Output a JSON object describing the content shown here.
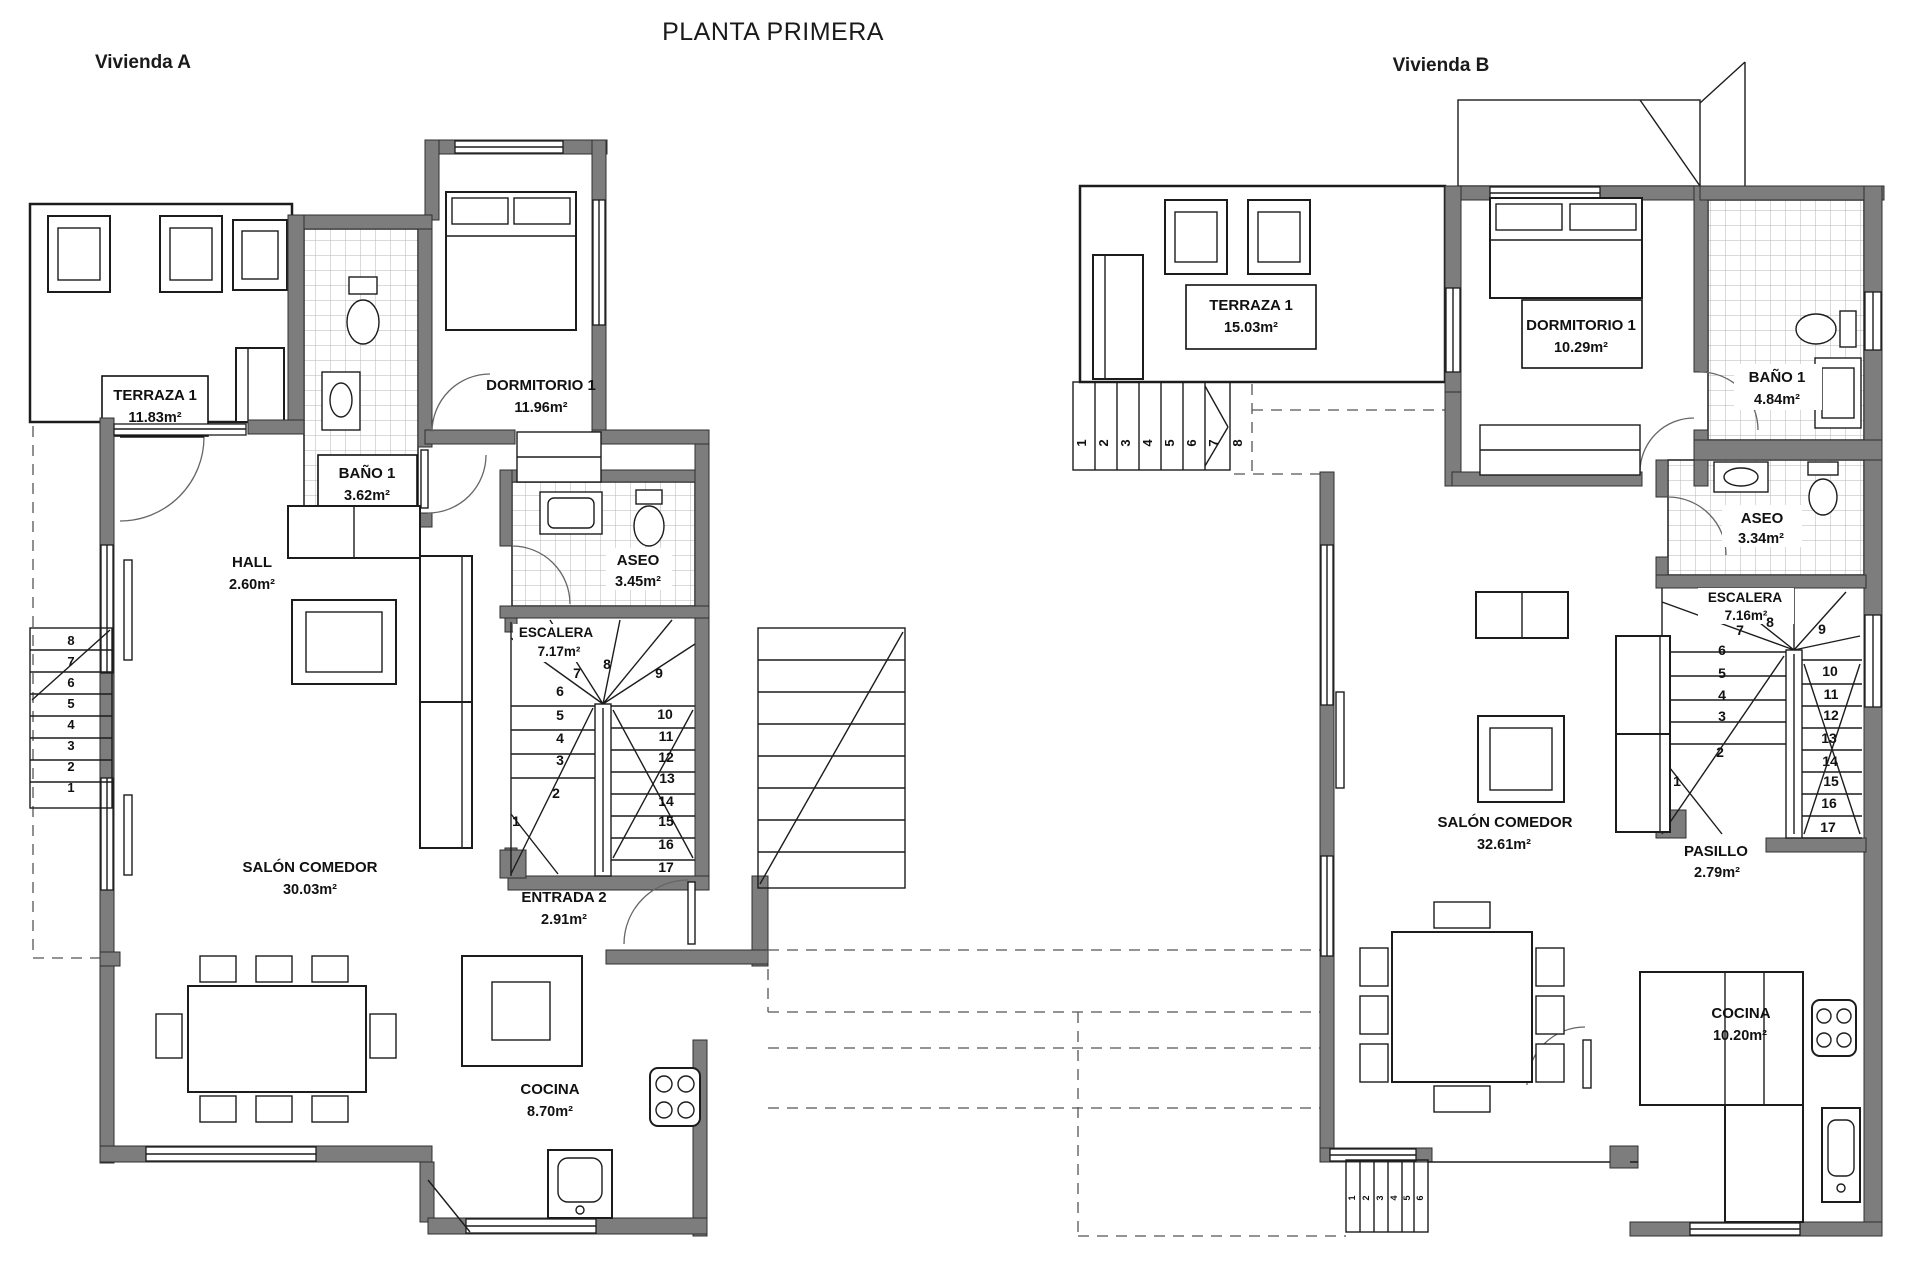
{
  "title": "PLANTA PRIMERA",
  "colors": {
    "wall_fill": "#7d7d7d",
    "line": "#1c1c1c",
    "tile_line": "#b4b4b4",
    "dash": "#555555"
  },
  "vivienda_a": {
    "label": "Vivienda A",
    "rooms": {
      "terraza": {
        "name": "TERRAZA 1",
        "area": "11.83m²"
      },
      "bano": {
        "name": "BAÑO 1",
        "area": "3.62m²"
      },
      "dormitorio": {
        "name": "DORMITORIO 1",
        "area": "11.96m²"
      },
      "hall": {
        "name": "HALL",
        "area": "2.60m²"
      },
      "aseo": {
        "name": "ASEO",
        "area": "3.45m²"
      },
      "escalera": {
        "name": "ESCALERA",
        "area": "7.17m²"
      },
      "salon": {
        "name": "SALÓN COMEDOR",
        "area": "30.03m²"
      },
      "entrada": {
        "name": "ENTRADA 2",
        "area": "2.91m²"
      },
      "cocina": {
        "name": "COCINA",
        "area": "8.70m²"
      }
    },
    "interior_steps": [
      "1",
      "2",
      "3",
      "4",
      "5",
      "6",
      "7",
      "8",
      "9",
      "10",
      "11",
      "12",
      "13",
      "14",
      "15",
      "16",
      "17"
    ],
    "exterior_steps": [
      "1",
      "2",
      "3",
      "4",
      "5",
      "6",
      "7",
      "8"
    ]
  },
  "vivienda_b": {
    "label": "Vivienda B",
    "rooms": {
      "terraza": {
        "name": "TERRAZA 1",
        "area": "15.03m²"
      },
      "dormitorio": {
        "name": "DORMITORIO 1",
        "area": "10.29m²"
      },
      "bano": {
        "name": "BAÑO 1",
        "area": "4.84m²"
      },
      "aseo": {
        "name": "ASEO",
        "area": "3.34m²"
      },
      "escalera": {
        "name": "ESCALERA",
        "area": "7.16m²"
      },
      "salon": {
        "name": "SALÓN COMEDOR",
        "area": "32.61m²"
      },
      "pasillo": {
        "name": "PASILLO",
        "area": "2.79m²"
      },
      "cocina": {
        "name": "COCINA",
        "area": "10.20m²"
      }
    },
    "interior_steps": [
      "1",
      "2",
      "3",
      "4",
      "5",
      "6",
      "7",
      "8",
      "9",
      "10",
      "11",
      "12",
      "13",
      "14",
      "15",
      "16",
      "17"
    ],
    "exterior_steps": [
      "1",
      "2",
      "3",
      "4",
      "5",
      "6",
      "7",
      "8"
    ],
    "porch_steps": [
      "1",
      "2",
      "3",
      "4",
      "5",
      "6"
    ]
  }
}
